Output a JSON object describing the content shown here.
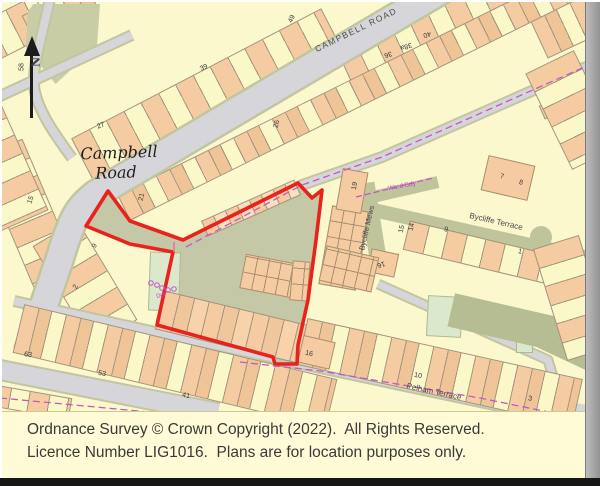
{
  "page": {
    "background": "#FBF8CD"
  },
  "footer": {
    "line1": "Ordnance Survey © Crown Copyright (2022).  All Rights Reserved.",
    "line2": "Licence Number LIG1016.  Plans are for location purposes only."
  },
  "north_arrow": {
    "label": "N"
  },
  "site": {
    "boundary_points": "108,191 130,221 183,240 298,183 312,198 322,190 316,240 308,300 298,345 297,364 275,364 273,357 157,325 173,252 130,244 86,226",
    "fill": "#C5C8A6",
    "boundary_color": "#E8231E",
    "boundary_width": "3.6"
  },
  "ward_lines": [
    {
      "name": "ward-boundary-road",
      "points": "186,247 302,185 382,157 598,61",
      "color": "#C25AC2",
      "dash": "7 4",
      "w": 1.3
    },
    {
      "name": "ward-boundary-connector",
      "points": "356,197 433,178",
      "color": "#C25AC2",
      "dash": "6 3",
      "w": 1.3
    },
    {
      "name": "ward-boundary-pelham",
      "points": "240,362 320,371 480,398 568,416",
      "color": "#C25AC2",
      "dash": "7 4",
      "w": 1.3
    },
    {
      "name": "ward-boundary-bottom-left",
      "points": "0,398 170,414",
      "color": "#C25AC2",
      "dash": "7 4",
      "w": 1.3
    },
    {
      "name": "boundary-tick",
      "points": "174,242 174,252",
      "color": "#F2738F",
      "dash": "",
      "w": 1.6
    }
  ],
  "def_circles": [
    {
      "cx": 151,
      "cy": 283
    },
    {
      "cx": 157,
      "cy": 285
    },
    {
      "cx": 162,
      "cy": 288
    },
    {
      "cx": 168,
      "cy": 290
    },
    {
      "cx": 174,
      "cy": 289
    }
  ],
  "labels": [
    {
      "n": "street-label-campbell-road-caps",
      "k": "caps",
      "t": "CAMPBELL ROAD",
      "x": 356,
      "y": 30,
      "r": -26,
      "s": 8.5
    },
    {
      "n": "street-label-campbell",
      "k": "italic",
      "t": "Campbell",
      "x": 119,
      "y": 153,
      "r": -2,
      "s": 16
    },
    {
      "n": "street-label-road",
      "k": "italic",
      "t": "Road",
      "x": 116,
      "y": 173,
      "r": -2,
      "s": 16
    },
    {
      "n": "street-label-bycliffe-terrace",
      "k": "street",
      "t": "Bycliffe Terrace",
      "x": 496,
      "y": 222,
      "r": 13,
      "s": 8
    },
    {
      "n": "street-label-bycliffe-mews",
      "k": "street",
      "t": "Bycliffe Mews",
      "x": 367,
      "y": 228,
      "r": -77,
      "s": 7.5
    },
    {
      "n": "ward-bdy-label",
      "k": "mag",
      "t": "Ward Bdy",
      "x": 402,
      "y": 187,
      "r": -10,
      "s": 6.5
    },
    {
      "n": "street-label-pelham-terrace",
      "k": "street",
      "t": "Pelham Terrace",
      "x": 434,
      "y": 392,
      "r": 12,
      "s": 8
    },
    {
      "n": "def-label",
      "k": "mag",
      "t": "Def",
      "x": 161,
      "y": 296,
      "r": -15,
      "s": 6
    },
    {
      "n": "house-number",
      "k": "num",
      "t": "58",
      "x": 22,
      "y": 67,
      "r": -90,
      "s": 7
    },
    {
      "n": "house-number",
      "k": "num",
      "t": "15",
      "x": 31,
      "y": 200,
      "r": -70,
      "s": 7
    },
    {
      "n": "house-number",
      "k": "num",
      "t": "9",
      "x": 95,
      "y": 246,
      "r": -62,
      "s": 7
    },
    {
      "n": "house-number",
      "k": "num",
      "t": "2",
      "x": 76,
      "y": 287,
      "r": -62,
      "s": 7
    },
    {
      "n": "house-number",
      "k": "num",
      "t": "27",
      "x": 101,
      "y": 126,
      "r": -20,
      "s": 7
    },
    {
      "n": "house-number",
      "k": "num",
      "t": "39",
      "x": 204,
      "y": 68,
      "r": -25,
      "s": 7
    },
    {
      "n": "house-number",
      "k": "num",
      "t": "49",
      "x": 292,
      "y": 19,
      "r": -65,
      "s": 7
    },
    {
      "n": "house-number",
      "k": "num",
      "t": "21",
      "x": 142,
      "y": 197,
      "r": -78,
      "s": 7
    },
    {
      "n": "house-number",
      "k": "num",
      "t": "26",
      "x": 277,
      "y": 124,
      "r": -78,
      "s": 7
    },
    {
      "n": "house-number",
      "k": "num",
      "t": "36",
      "x": 388,
      "y": 54,
      "r": 162,
      "s": 7
    },
    {
      "n": "house-number",
      "k": "num",
      "t": "38a",
      "x": 406,
      "y": 46,
      "r": 162,
      "s": 7
    },
    {
      "n": "house-number",
      "k": "num",
      "t": "40",
      "x": 427,
      "y": 34,
      "r": 162,
      "s": 7
    },
    {
      "n": "house-number",
      "k": "num",
      "t": "19",
      "x": 355,
      "y": 186,
      "r": -80,
      "s": 7
    },
    {
      "n": "house-number",
      "k": "num",
      "t": "7",
      "x": 502,
      "y": 177,
      "r": 12,
      "s": 7
    },
    {
      "n": "house-number",
      "k": "num",
      "t": "8",
      "x": 521,
      "y": 183,
      "r": 12,
      "s": 7
    },
    {
      "n": "house-number",
      "k": "num",
      "t": "15",
      "x": 402,
      "y": 229,
      "r": -78,
      "s": 7
    },
    {
      "n": "house-number",
      "k": "num",
      "t": "14",
      "x": 412,
      "y": 227,
      "r": -78,
      "s": 7
    },
    {
      "n": "house-number",
      "k": "num",
      "t": "9",
      "x": 446,
      "y": 230,
      "r": 12,
      "s": 7
    },
    {
      "n": "house-number",
      "k": "num",
      "t": "16",
      "x": 381,
      "y": 264,
      "r": 162,
      "s": 7
    },
    {
      "n": "house-number",
      "k": "num",
      "t": "1",
      "x": 520,
      "y": 252,
      "r": 12,
      "s": 7
    },
    {
      "n": "house-number",
      "k": "num",
      "t": "16",
      "x": 309,
      "y": 354,
      "r": 12,
      "s": 7
    },
    {
      "n": "house-number",
      "k": "num",
      "t": "63",
      "x": 28,
      "y": 355,
      "r": 8,
      "s": 7
    },
    {
      "n": "house-number",
      "k": "num",
      "t": "53",
      "x": 102,
      "y": 374,
      "r": 10,
      "s": 7
    },
    {
      "n": "house-number",
      "k": "num",
      "t": "41",
      "x": 186,
      "y": 396,
      "r": 10,
      "s": 7
    },
    {
      "n": "house-number",
      "k": "num",
      "t": "10",
      "x": 418,
      "y": 376,
      "r": 10,
      "s": 7
    },
    {
      "n": "house-number",
      "k": "num",
      "t": "3",
      "x": 530,
      "y": 399,
      "r": 10,
      "s": 7
    }
  ]
}
